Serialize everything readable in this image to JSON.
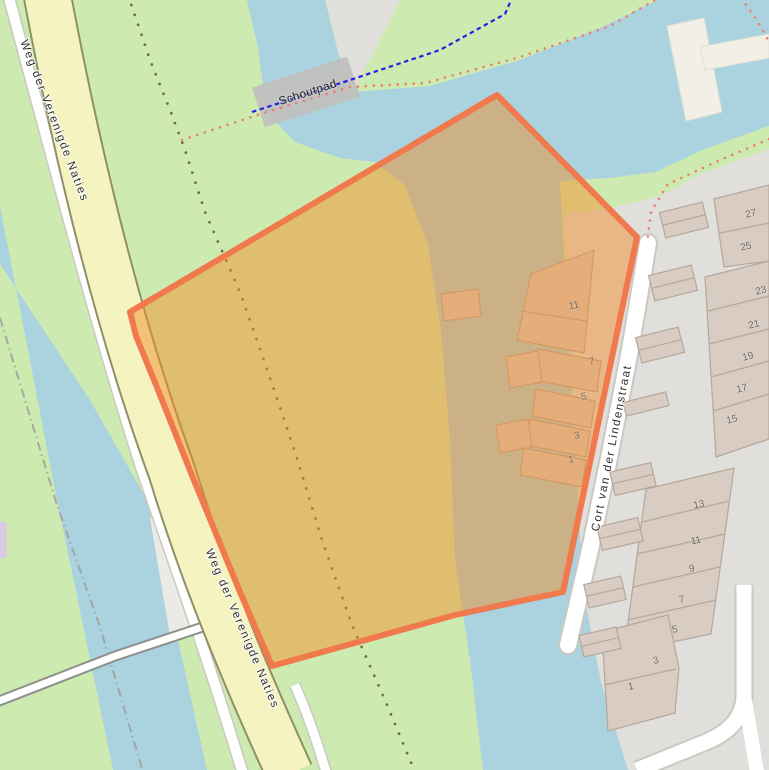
{
  "map": {
    "selected_feature": "highlighted parcel polygon between Weg der Verenigde Naties and Cort van der Lindenstraat"
  },
  "colors": {
    "grass": "#cdebb0",
    "water": "#aad3df",
    "residential": "#e1dfdc",
    "road_fill": "#f5f4c0",
    "road_casing": "#8f8f68",
    "street_fill": "#ffffff",
    "street_casing": "#cbc8c2",
    "footpath_red": "#ee7f6e",
    "cycleway_blue": "#2323e6",
    "track_brown": "#7a6a48",
    "boundary_gray": "#9d9d9d",
    "building_fill": "#d8ccc3",
    "building_stroke": "#b5a79a",
    "bridge": "#c1c0be",
    "pier": "#f2efe7",
    "pier_stroke": "#e3ded2",
    "selection_fill": "rgba(242,140,40,0.48)",
    "selection_stroke": "#f0794e",
    "house_number": "#6f675e"
  },
  "labels": [
    {
      "name": "road-label-weg-top",
      "text": "Weg der Verenigde Naties",
      "x": 54,
      "y": 121,
      "rot": 69,
      "cls": "road"
    },
    {
      "name": "road-label-weg-bottom",
      "text": "Weg der Verenigde Naties",
      "x": 242,
      "y": 629,
      "rot": 67,
      "cls": "road"
    },
    {
      "name": "road-label-cort",
      "text": "Cort van der Lindenstraat",
      "x": 612,
      "y": 448,
      "rot": -79,
      "cls": "road"
    },
    {
      "name": "bridge-label-schoutpad",
      "text": "Schoutpad",
      "x": 308,
      "y": 93,
      "rot": -18,
      "cls": "bridge"
    },
    {
      "name": "house-number",
      "text": "27",
      "x": 751,
      "y": 214,
      "rot": -14,
      "cls": "house"
    },
    {
      "name": "house-number",
      "text": "25",
      "x": 746,
      "y": 247,
      "rot": -14,
      "cls": "house"
    },
    {
      "name": "house-number",
      "text": "23",
      "x": 761,
      "y": 291,
      "rot": -14,
      "cls": "house"
    },
    {
      "name": "house-number",
      "text": "21",
      "x": 754,
      "y": 325,
      "rot": -14,
      "cls": "house"
    },
    {
      "name": "house-number",
      "text": "19",
      "x": 748,
      "y": 357,
      "rot": -14,
      "cls": "house"
    },
    {
      "name": "house-number",
      "text": "17",
      "x": 742,
      "y": 389,
      "rot": -14,
      "cls": "house"
    },
    {
      "name": "house-number",
      "text": "15",
      "x": 732,
      "y": 420,
      "rot": -14,
      "cls": "house"
    },
    {
      "name": "house-number",
      "text": "13",
      "x": 699,
      "y": 505,
      "rot": -12,
      "cls": "house"
    },
    {
      "name": "house-number",
      "text": "11",
      "x": 696,
      "y": 541,
      "rot": -12,
      "cls": "house"
    },
    {
      "name": "house-number",
      "text": "9",
      "x": 692,
      "y": 569,
      "rot": -12,
      "cls": "house"
    },
    {
      "name": "house-number",
      "text": "7",
      "x": 682,
      "y": 600,
      "rot": -12,
      "cls": "house"
    },
    {
      "name": "house-number",
      "text": "5",
      "x": 675,
      "y": 630,
      "rot": -12,
      "cls": "house"
    },
    {
      "name": "house-number",
      "text": "3",
      "x": 656,
      "y": 661,
      "rot": -12,
      "cls": "house"
    },
    {
      "name": "house-number",
      "text": "1",
      "x": 631,
      "y": 687,
      "rot": -12,
      "cls": "house"
    },
    {
      "name": "house-number",
      "text": "11",
      "x": 574,
      "y": 306,
      "rot": -12,
      "cls": "house"
    },
    {
      "name": "house-number",
      "text": "7",
      "x": 592,
      "y": 362,
      "rot": -12,
      "cls": "house"
    },
    {
      "name": "house-number",
      "text": "5",
      "x": 584,
      "y": 397,
      "rot": -12,
      "cls": "house"
    },
    {
      "name": "house-number",
      "text": "3",
      "x": 577,
      "y": 436,
      "rot": -12,
      "cls": "house"
    },
    {
      "name": "house-number",
      "text": "1",
      "x": 571,
      "y": 460,
      "rot": -12,
      "cls": "house"
    }
  ]
}
